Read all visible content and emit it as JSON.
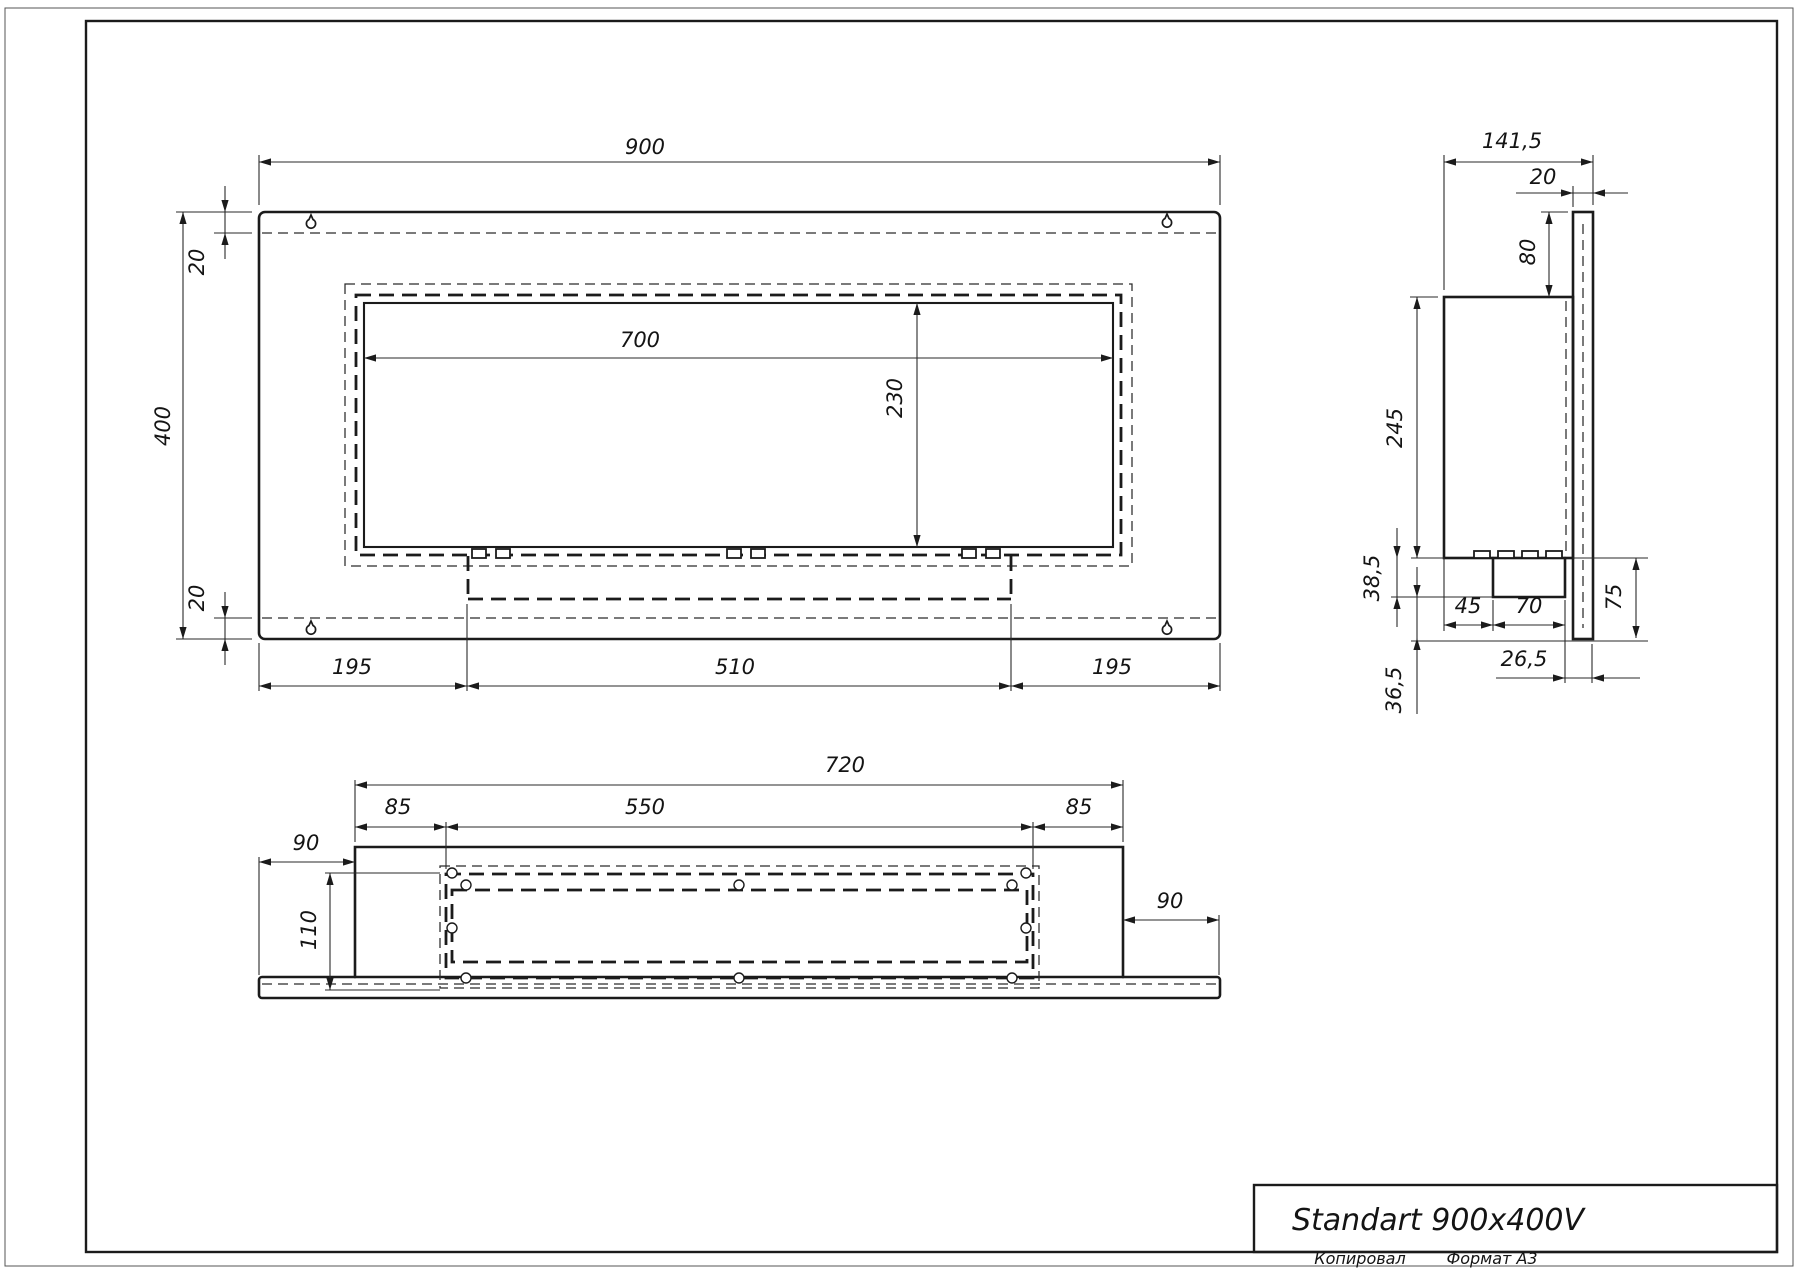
{
  "drawing": {
    "title": "Standart 900x400V",
    "stamp_copied": "Копировал",
    "stamp_format": "Формат А3"
  },
  "front_view": {
    "overall_width": "900",
    "overall_height": "400",
    "top_offset": "20",
    "bottom_offset": "20",
    "opening_width": "700",
    "opening_height": "230",
    "bottom_left": "195",
    "bottom_center": "510",
    "bottom_right": "195"
  },
  "side_view": {
    "overall_depth": "141,5",
    "mount_plate_thickness": "20",
    "top_drop": "80",
    "body_height": "245",
    "tray_height": "38,5",
    "tray_bottom_offset": "36,5",
    "seg_45": "45",
    "seg_70": "70",
    "plate_lower_height": "75",
    "back_offset": "26,5"
  },
  "plan_view": {
    "body_width": "720",
    "opening_width": "550",
    "margin_left": "85",
    "margin_right": "85",
    "ext_left": "90",
    "ext_right": "90",
    "depth": "110"
  }
}
